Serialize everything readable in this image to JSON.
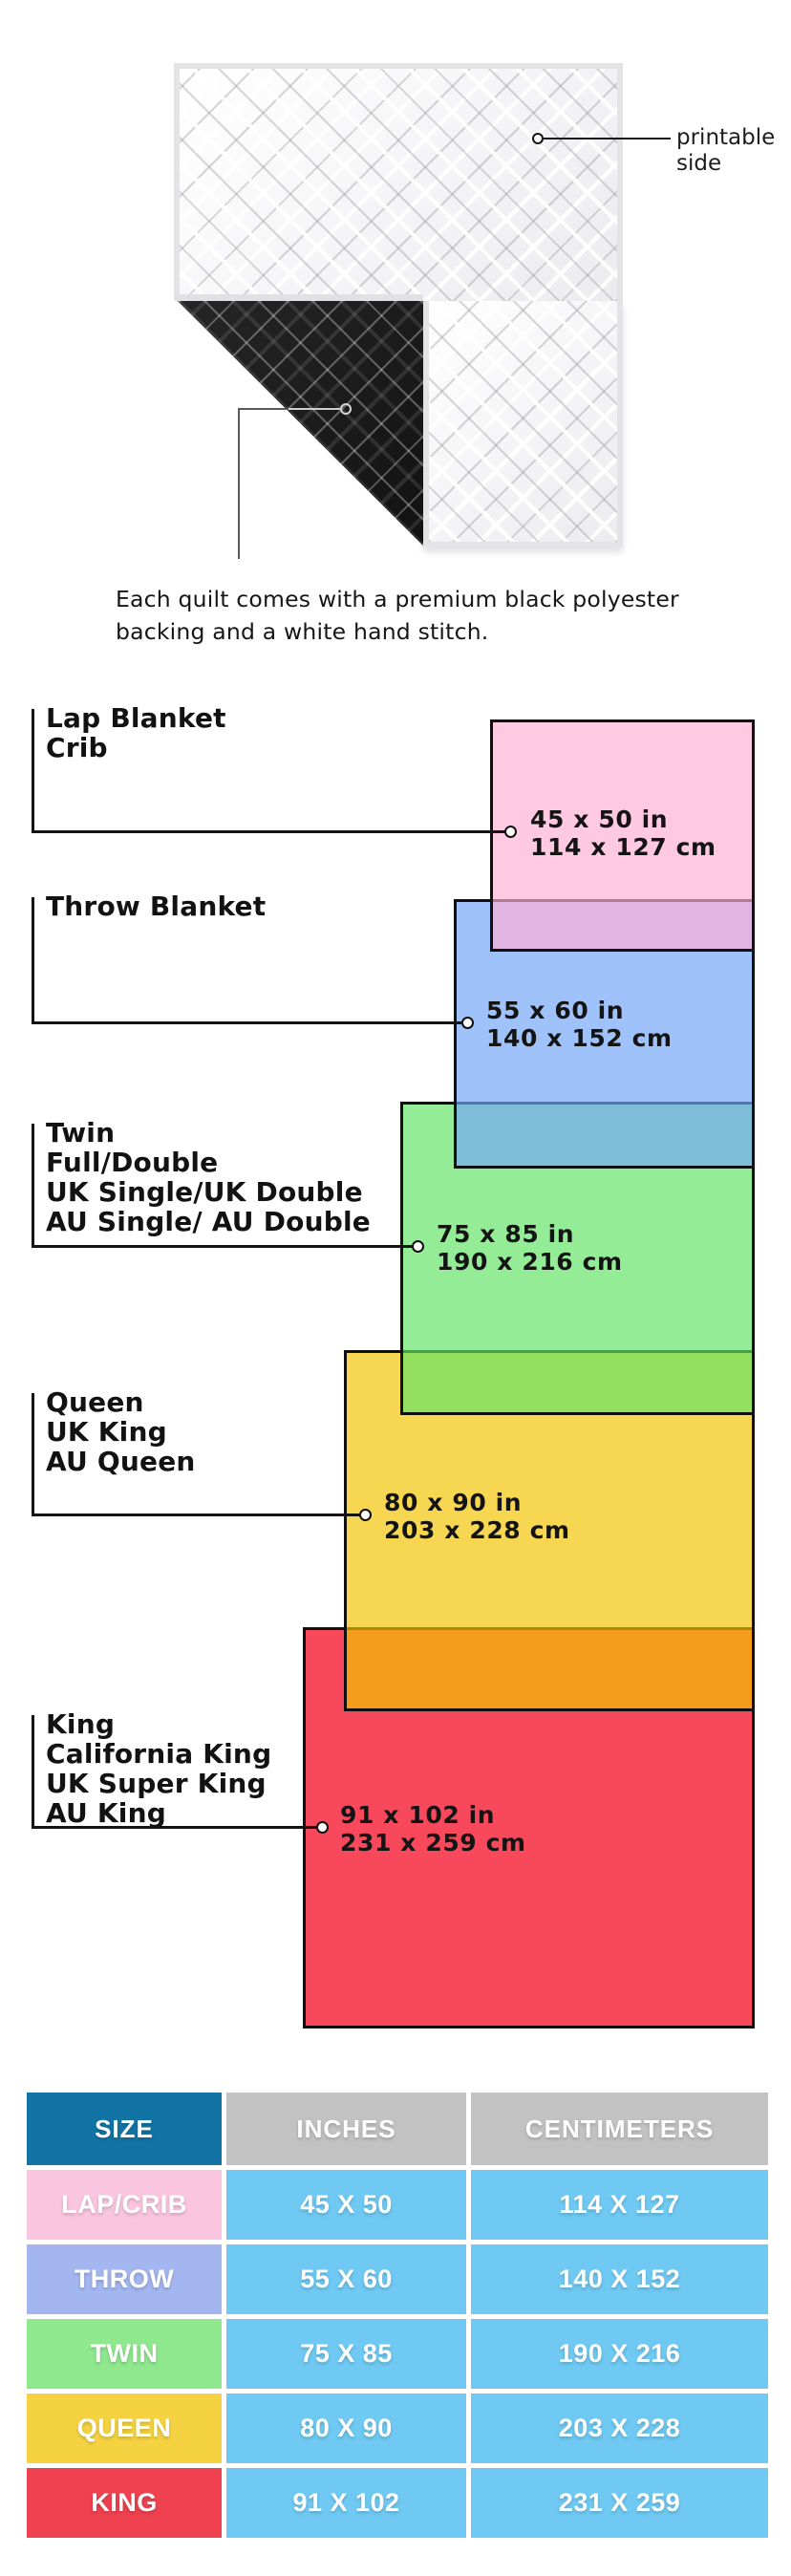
{
  "quilt": {
    "printable_lines": [
      "printable",
      "side"
    ],
    "caption_lines": [
      "Each quilt comes with a premium black polyester",
      "backing and a white hand stitch."
    ]
  },
  "diagram": {
    "blankets": [
      {
        "names": [
          "Lap Blanket",
          "Crib"
        ],
        "size_in": "45 x 50 in",
        "size_cm": "114 x 127 cm",
        "color": "#ffc9e2"
      },
      {
        "names": [
          "Throw Blanket"
        ],
        "size_in": "55 x 60 in",
        "size_cm": "140 x 152 cm",
        "color": "#a0c2fa"
      },
      {
        "names": [
          "Twin",
          "Full/Double",
          "UK Single/UK Double",
          "AU Single/ AU Double"
        ],
        "size_in": "75 x 85 in",
        "size_cm": "190 x 216 cm",
        "color": "#95ec96"
      },
      {
        "names": [
          "Queen",
          "UK King",
          "AU Queen"
        ],
        "size_in": "80 x 90 in",
        "size_cm": "203 x 228 cm",
        "color": "#f7d63f"
      },
      {
        "names": [
          "King",
          "California King",
          "UK Super King",
          "AU King"
        ],
        "size_in": "91 x 102 in",
        "size_cm": "231 x 259 cm",
        "color": "#f8495c"
      }
    ],
    "overlap_colors": {
      "lap_over_throw": "#e2b4e4",
      "throw_over_twin": "#85bcd9",
      "twin_over_queen": "#93de55",
      "queen_over_king": "#f4a32e"
    },
    "border_color": "#101010"
  },
  "table": {
    "headers": [
      "SIZE",
      "INCHES",
      "CENTIMETERS"
    ],
    "header_colors": {
      "size_bg": "#1274a5",
      "other_bg": "#c2c2c2"
    },
    "data_cell_bg": "#6fc9f2",
    "rows": [
      {
        "size": "LAP/CRIB",
        "inches": "45 X 50",
        "centimeters": "114 X 127",
        "color": "#f9c5df"
      },
      {
        "size": "THROW",
        "inches": "55 X 60",
        "centimeters": "140 X 152",
        "color": "#a3b6f0"
      },
      {
        "size": "TWIN",
        "inches": "75 X 85",
        "centimeters": "190 X 216",
        "color": "#8fe78e"
      },
      {
        "size": "QUEEN",
        "inches": "80 X 90",
        "centimeters": "203 X 228",
        "color": "#f5d242"
      },
      {
        "size": "KING",
        "inches": "91 X 102",
        "centimeters": "231 X 259",
        "color": "#ef4150"
      }
    ]
  }
}
